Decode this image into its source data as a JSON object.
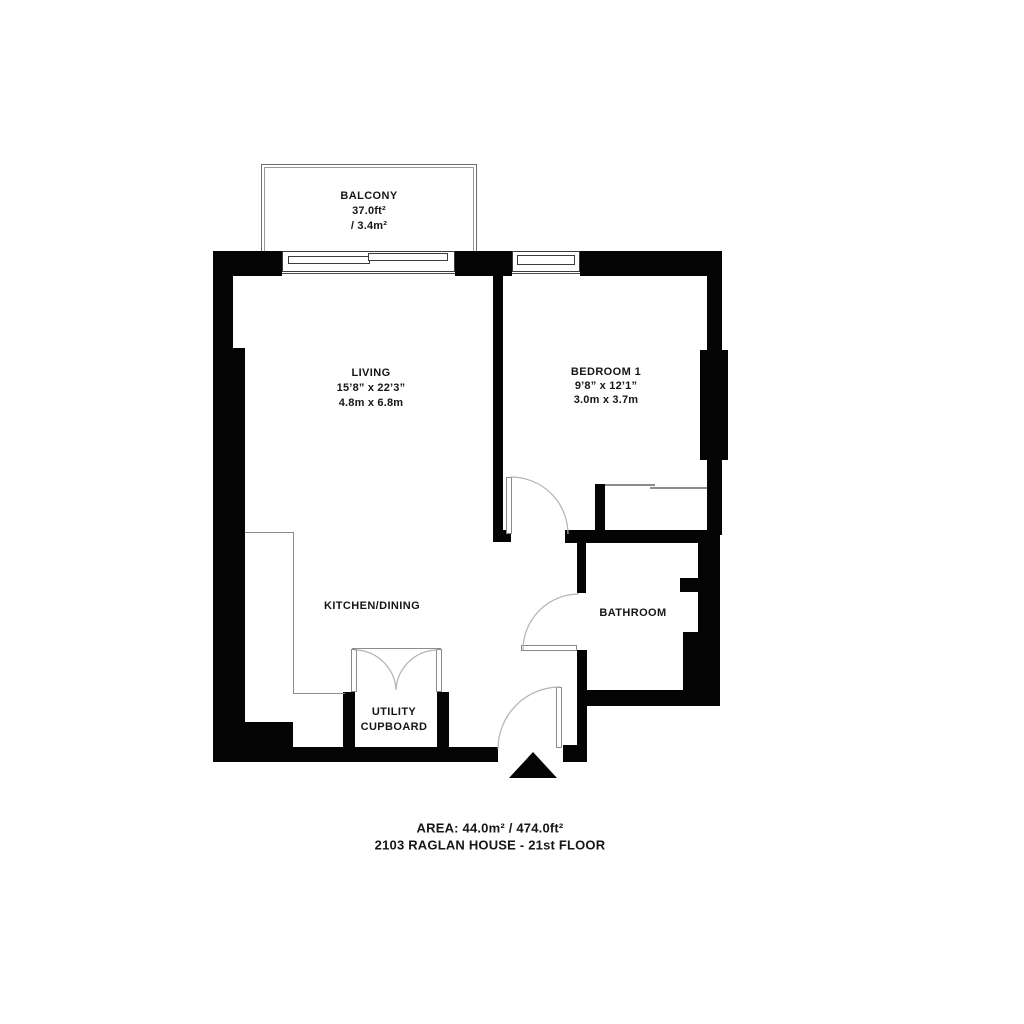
{
  "plan": {
    "rooms": {
      "balcony": {
        "name": "BALCONY",
        "area_imperial": "37.0ft²",
        "area_metric": "/ 3.4m²"
      },
      "living": {
        "name": "LIVING",
        "dims_imperial": "15’8” x 22’3”",
        "dims_metric": "4.8m x 6.8m"
      },
      "bedroom": {
        "name": "BEDROOM 1",
        "dims_imperial": "9’8” x 12’1”",
        "dims_metric": "3.0m x 3.7m"
      },
      "kitchen": {
        "name": "KITCHEN/DINING"
      },
      "bathroom": {
        "name": "BATHROOM"
      },
      "utility": {
        "name_line_1": "UTILITY",
        "name_line_2": "CUPBOARD"
      }
    },
    "footer": {
      "area": "AREA: 44.0m² / 474.0ft²",
      "unit": "2103 RAGLAN HOUSE - 21st FLOOR"
    },
    "icons": {
      "entrance_marker": "entrance-arrow"
    },
    "colors": {
      "wall": "#040404",
      "door_arc": "#b3b3b3",
      "window_frame": "#3c3c3c",
      "detail_line": "#8c8c8c",
      "text": "#161616",
      "background": "#ffffff"
    }
  }
}
